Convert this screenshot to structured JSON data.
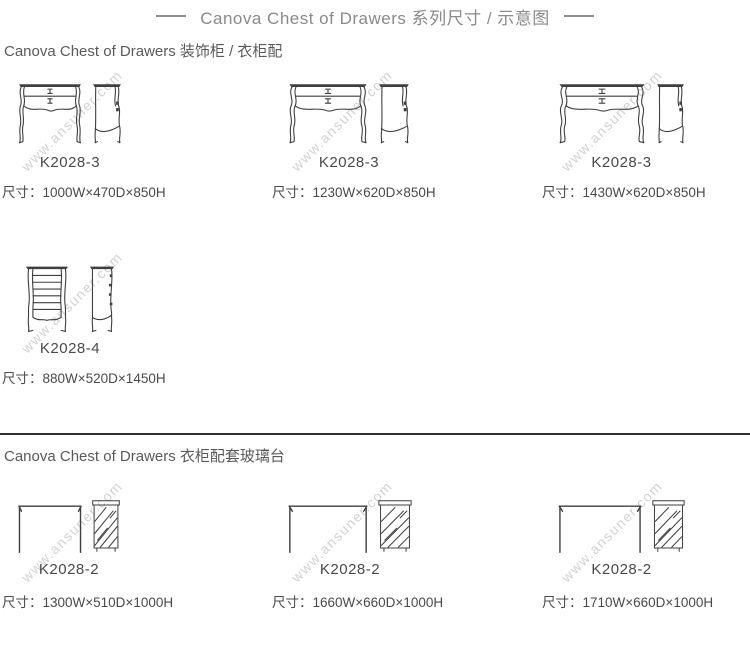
{
  "page": {
    "title": "Canova Chest of Drawers 系列尺寸 / 示意图",
    "watermark": "www.ansuner.com"
  },
  "colors": {
    "title_text": "#8a8a8a",
    "body_text": "#4a4a4a",
    "line_art": "#3f3f3f",
    "watermark": "#d2d2d2",
    "divider": "#2f2f2f"
  },
  "sections": [
    {
      "header": "Canova Chest of Drawers 装饰柜 / 衣柜配",
      "rows": [
        {
          "items": [
            {
              "model": "K2028-3",
              "dims": "尺寸：1000W×470D×850H",
              "drawing": "two-drawer-chest-front-and-side"
            },
            {
              "model": "K2028-3",
              "dims": "尺寸：1230W×620D×850H",
              "drawing": "two-drawer-chest-front-and-side"
            },
            {
              "model": "K2028-3",
              "dims": "尺寸：1430W×620D×850H",
              "drawing": "two-drawer-chest-front-and-side"
            }
          ]
        },
        {
          "items": [
            {
              "model": "K2028-4",
              "dims": "尺寸：880W×520D×1450H",
              "drawing": "tall-chest-front-and-side"
            }
          ]
        }
      ]
    },
    {
      "header": "Canova Chest of Drawers 衣柜配套玻璃台",
      "rows": [
        {
          "items": [
            {
              "model": "K2028-2",
              "dims": "尺寸：1300W×510D×1000H",
              "drawing": "glass-table-front-and-side"
            },
            {
              "model": "K2028-2",
              "dims": "尺寸：1660W×660D×1000H",
              "drawing": "glass-table-front-and-side"
            },
            {
              "model": "K2028-2",
              "dims": "尺寸：1710W×660D×1000H",
              "drawing": "glass-table-front-and-side"
            }
          ]
        }
      ]
    }
  ]
}
